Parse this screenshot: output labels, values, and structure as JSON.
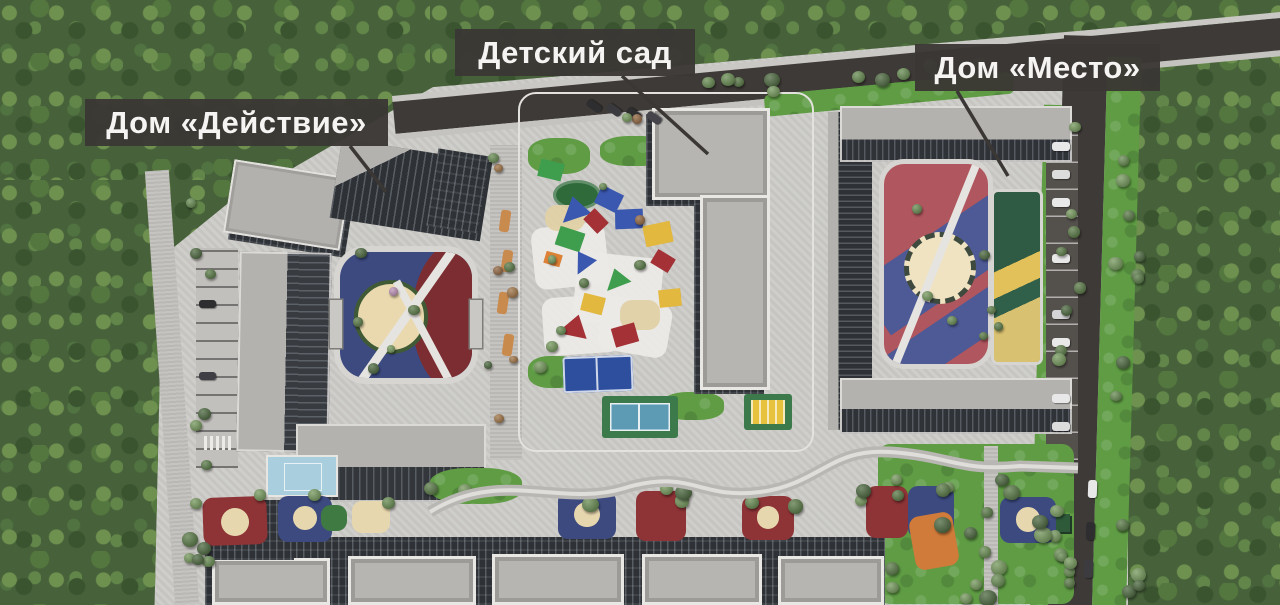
{
  "scene": {
    "labels": [
      {
        "id": "dom-deystvie",
        "text": "Дом «Действие»"
      },
      {
        "id": "detskiy-sad",
        "text": "Детский сад"
      },
      {
        "id": "dom-mesto",
        "text": "Дом «Место»"
      }
    ],
    "colors": {
      "label_bg": "#3a3734",
      "label_text": "#f5f4f2",
      "forest": "#47623a",
      "lawn": "#5f9c44",
      "road": "#3e3a37",
      "paving": "#cccbc7",
      "roof_light": "#b3b1ae",
      "facade_dark": "#2e3135",
      "play_navy": "#3c4a80",
      "play_red": "#8e3336",
      "play_sand": "#e7d7ae",
      "court_pool_blue": "#a9cfdf",
      "court_green": "#3c7a4c",
      "canopy_blue": "#3a58b0",
      "canopy_red": "#a33136",
      "canopy_green": "#3f9e4d",
      "canopy_yellow": "#e3b83e",
      "canopy_orange": "#dd8136"
    }
  }
}
